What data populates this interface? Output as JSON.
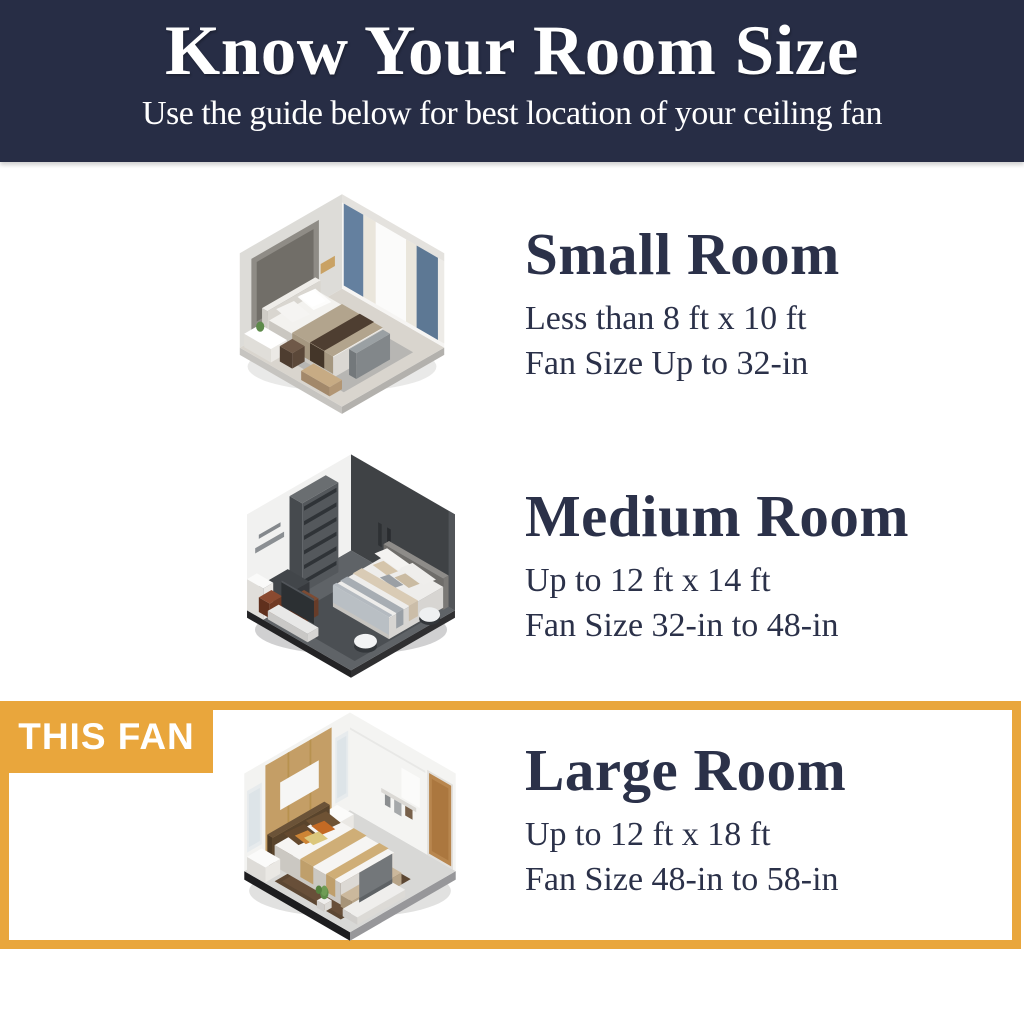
{
  "header": {
    "title": "Know Your Room Size",
    "subtitle": "Use the guide below for best location of your ceiling fan"
  },
  "badge": {
    "label": "THIS FAN"
  },
  "colors": {
    "header_bg": "#272d45",
    "header_text": "#ffffff",
    "heading_text": "#2b3149",
    "accent": "#e9a63c",
    "page_bg": "#ffffff"
  },
  "sections": [
    {
      "id": "small",
      "title": "Small Room",
      "dimensions": "Less than 8 ft x 10 ft",
      "fan_size": "Fan Size Up to 32-in",
      "illustration": "small-bedroom-isometric",
      "highlighted": false
    },
    {
      "id": "medium",
      "title": "Medium Room",
      "dimensions": "Up to 12 ft x 14 ft",
      "fan_size": "Fan Size 32-in to 48-in",
      "illustration": "medium-bedroom-isometric",
      "highlighted": false
    },
    {
      "id": "large",
      "title": "Large Room",
      "dimensions": "Up to 12 ft x 18 ft",
      "fan_size": "Fan Size 48-in to 58-in",
      "illustration": "large-bedroom-isometric",
      "highlighted": true
    }
  ]
}
